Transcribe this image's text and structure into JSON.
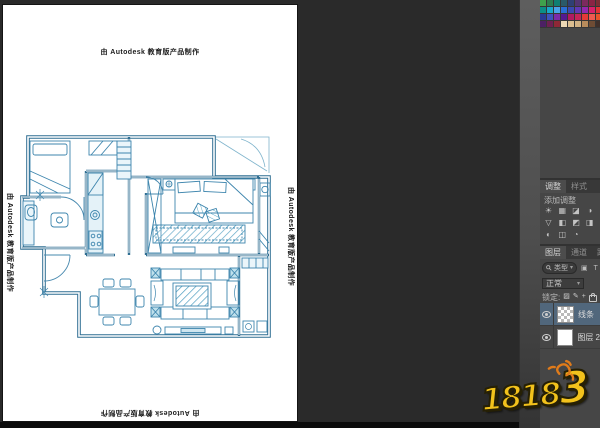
{
  "canvas": {
    "autodesk_top": "由 Autodesk 教育版产品制作",
    "autodesk_left": "由 Autodesk 教育版产品制作",
    "autodesk_right": "由 Autodesk 教育版产品制作",
    "autodesk_bottom": "由 Autodesk 教育版产品制作"
  },
  "watermark": {
    "text_main": "1818",
    "text_last": "3",
    "color": "#f2c21c",
    "sun_color": "#e07b1a"
  },
  "swatches": {
    "cols": 9,
    "colors": [
      "#3fa14d",
      "#2c7d4f",
      "#0f7f72",
      "#2a5a68",
      "#2f3f74",
      "#533472",
      "#7c2a5e",
      "#8a2444",
      "#7c2e34",
      "#0c8f86",
      "#18a7c9",
      "#4aa3e8",
      "#2a6fd4",
      "#3a49b0",
      "#6038b4",
      "#9428ae",
      "#d8216a",
      "#e03434",
      "#2a3a94",
      "#3e51bc",
      "#7c2aa8",
      "#541a90",
      "#b01a60",
      "#c42458",
      "#e43a38",
      "#ee5a50",
      "#e8542a",
      "#4c2064",
      "#6e2052",
      "#8e2836",
      "#ecd8b4",
      "#dcbe90",
      "#d2b284",
      "#b88c5c",
      "#6e4c34",
      "#40302a"
    ]
  },
  "adjustments": {
    "tab_adjustments": "调整",
    "tab_styles": "样式",
    "add_label": "添加调整",
    "icons": [
      {
        "name": "brightness-contrast",
        "glyph": "☀"
      },
      {
        "name": "levels",
        "glyph": "▦"
      },
      {
        "name": "curves",
        "glyph": "◪"
      },
      {
        "name": "exposure",
        "glyph": "◑"
      },
      {
        "name": "vibrance",
        "glyph": "▽"
      },
      {
        "name": "hue-saturation",
        "glyph": "◧"
      },
      {
        "name": "color-balance",
        "glyph": "◩"
      },
      {
        "name": "black-white",
        "glyph": "◨"
      },
      {
        "name": "photo-filter",
        "glyph": "◐"
      },
      {
        "name": "channel-mixer",
        "glyph": "◫"
      },
      {
        "name": "color-lookup",
        "glyph": "◔"
      }
    ]
  },
  "layers_panel": {
    "tab_layers": "图层",
    "tab_channels": "通道",
    "tab_paths": "路径",
    "kind_label": "类型",
    "filter_icons": "▣ T",
    "blend_mode": "正常",
    "lock_label": "锁定:",
    "layers": [
      {
        "name": "线条",
        "selected": true,
        "thumb": "checker"
      },
      {
        "name": "图层 2",
        "selected": false,
        "thumb": "white"
      }
    ]
  }
}
